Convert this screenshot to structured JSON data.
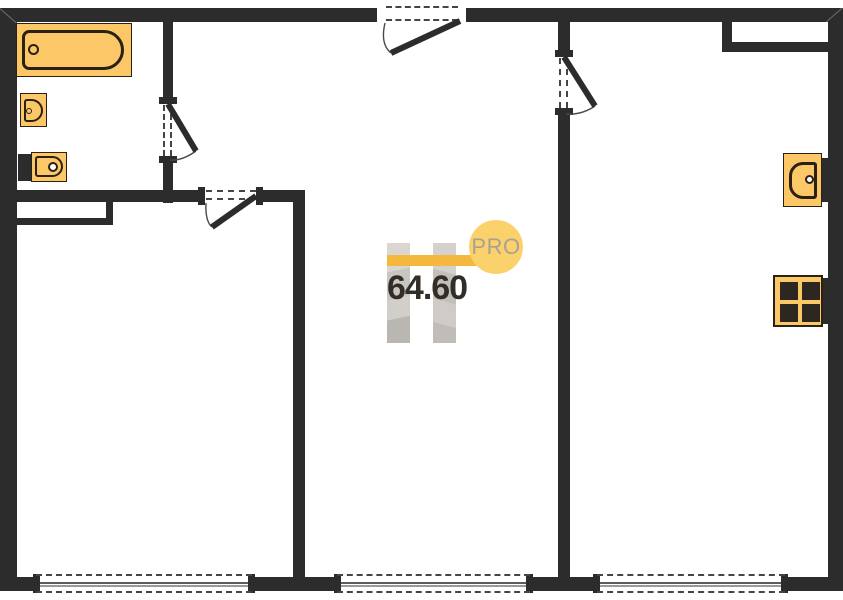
{
  "watermark": {
    "badge_label": "PRO",
    "area_value": "64.60"
  },
  "colors": {
    "wall": "#2c2c2c",
    "fixture_fill": "#fcc766",
    "fixture_stroke": "#2a2014",
    "accent_bar": "#f4b83e",
    "badge_fill": "#fbd16c",
    "badge_text": "#a8a196",
    "area_text": "#332d27",
    "logo_gray": "#cdc9c4"
  },
  "plan": {
    "type": "apartment-floor-plan",
    "total_area": "64.60",
    "windows_count": 3,
    "doors_count": 4,
    "fixture_icons": [
      "bathtub-icon",
      "washbasin-icon",
      "toilet-icon",
      "wall-washbasin-icon",
      "stove-icon"
    ]
  }
}
